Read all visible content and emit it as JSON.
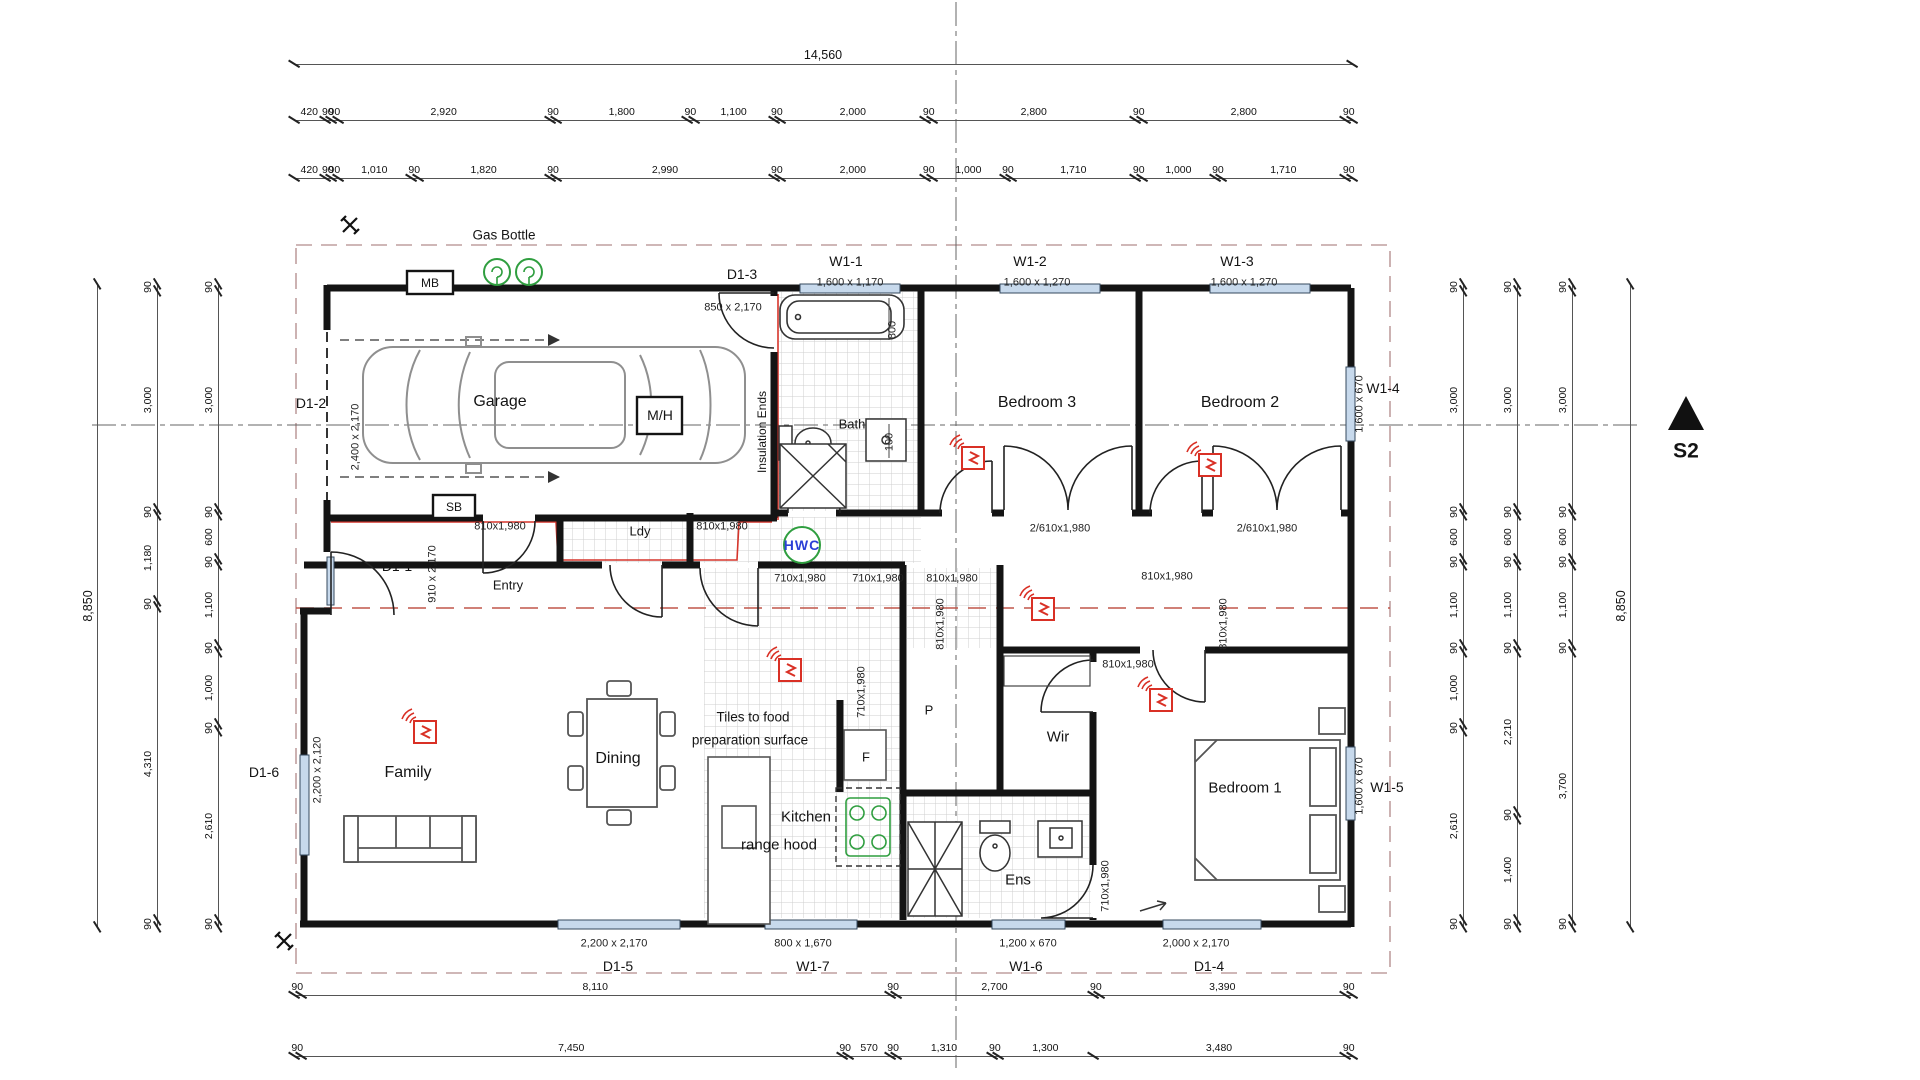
{
  "rooms": {
    "garage": "Garage",
    "bath": "Bath",
    "bedroom3": "Bedroom 3",
    "bedroom2": "Bedroom 2",
    "entry": "Entry",
    "laundry": "Ldy",
    "family": "Family",
    "dining": "Dining",
    "kitchen_line1": "Kitchen",
    "kitchen_line2": "range hood",
    "fridge": "F",
    "pantry": "P",
    "wardrobe": "Wir",
    "ensuite": "Ens",
    "bedroom1": "Bedroom 1"
  },
  "annotations": {
    "gas_bottle": "Gas Bottle",
    "meter_board": "MB",
    "switch_board": "SB",
    "manhole": "M/H",
    "hot_water": "HWC",
    "insulation": "Insulation Ends",
    "tiles_line1": "Tiles to food",
    "tiles_line2": "preparation surface",
    "section_marker": "S2"
  },
  "openings": {
    "w1_1": {
      "id": "W1-1",
      "size": "1,600 x 1,170"
    },
    "w1_2": {
      "id": "W1-2",
      "size": "1,600 x 1,270"
    },
    "w1_3": {
      "id": "W1-3",
      "size": "1,600 x 1,270"
    },
    "w1_4": {
      "id": "W1-4",
      "size": "1,600 x 670"
    },
    "w1_5": {
      "id": "W1-5",
      "size": "1,600 x 670"
    },
    "w1_6": {
      "id": "W1-6",
      "size": "1,200 x 670"
    },
    "w1_7": {
      "id": "W1-7",
      "size": "800 x 1,670"
    },
    "d1_1": {
      "id": "D1-1",
      "size": "910 x 2,170"
    },
    "d1_2": {
      "id": "D1-2",
      "size": "2,400 x 2,170"
    },
    "d1_3": {
      "id": "D1-3",
      "size": "850 x 2,170"
    },
    "d1_4": {
      "id": "D1-4",
      "size": "2,000 x 2,170"
    },
    "d1_5": {
      "id": "D1-5",
      "size": "2,200 x 2,170"
    },
    "d1_6": {
      "id": "D1-6",
      "size": "2,200 x 2,120"
    }
  },
  "door_tags": {
    "d810": "810x1,980",
    "d710": "710x1,980",
    "wardrobe_doors": "2/610x1,980",
    "bath_800": "800",
    "bath_100": "100"
  },
  "dims": {
    "top_overall": [
      "14,560"
    ],
    "top_row2": [
      "420",
      "90",
      "90",
      "2,920",
      "90",
      "1,800",
      "90",
      "1,100",
      "90",
      "2,000",
      "90",
      "2,800",
      "90",
      "2,800",
      "90"
    ],
    "top_row3": [
      "420",
      "90",
      "90",
      "1,010",
      "90",
      "1,820",
      "90",
      "2,990",
      "90",
      "2,000",
      "90",
      "1,000",
      "90",
      "1,710",
      "90",
      "1,000",
      "90",
      "1,710",
      "90"
    ],
    "bottom_row1": [
      "90",
      "8,110",
      "90",
      "2,700",
      "90",
      "3,390",
      "90"
    ],
    "bottom_row2": [
      "90",
      "7,450",
      "90",
      "570",
      "90",
      "1,310",
      "90",
      "1,300",
      "3,480",
      "90"
    ],
    "left_outer": [
      "8,850"
    ],
    "left_col2": [
      "90",
      "3,000",
      "90",
      "1,180",
      "90",
      "4,310",
      "90"
    ],
    "left_col3": [
      "90",
      "3,000",
      "90",
      "600",
      "90",
      "1,100",
      "90",
      "1,000",
      "90",
      "2,610",
      "90"
    ],
    "right_col1": [
      "90",
      "3,000",
      "90",
      "600",
      "90",
      "1,100",
      "90",
      "1,000",
      "90",
      "2,610",
      "90"
    ],
    "right_col2": [
      "90",
      "3,000",
      "90",
      "600",
      "90",
      "1,100",
      "90",
      "2,210",
      "90",
      "1,400",
      "90"
    ],
    "right_col3": [
      "90",
      "3,000",
      "90",
      "600",
      "90",
      "1,100",
      "90",
      "3,700",
      "90"
    ],
    "right_outer": [
      "8,850"
    ]
  },
  "colors": {
    "wall": "#141414",
    "boundary_dash": "#bf9f9f",
    "section_red": "#c0564a",
    "insulation_red": "#d6352b",
    "alarm_red": "#d93025",
    "green": "#2f9e3f",
    "window_glass": "#c7d9ec",
    "hwc_text": "#2b3fd6"
  }
}
